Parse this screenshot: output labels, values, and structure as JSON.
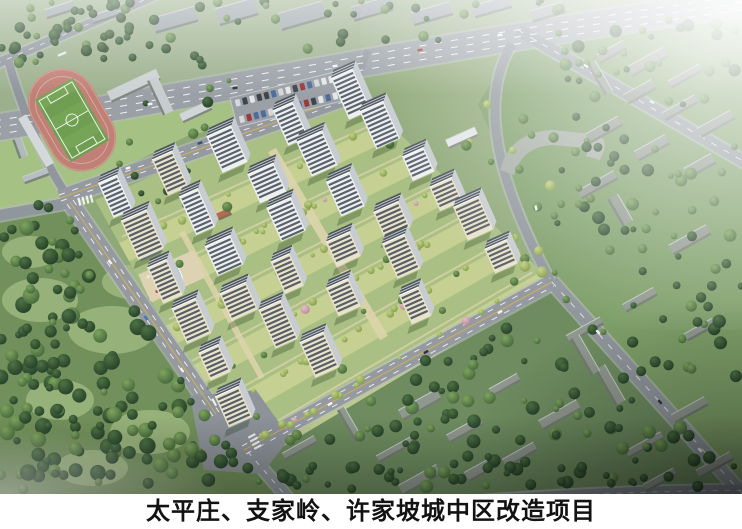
{
  "caption": {
    "text": "太平庄、支家岭、许家坡城中区改造项目"
  },
  "palette": {
    "caption_background": "#ffffff",
    "caption_text": "#121212",
    "haze_white": "#ffffff",
    "grass_base": "#8fa878",
    "forest_dark": "#3c5a34",
    "complex_lawn": "#a9bf83",
    "landscape_band": "#c9d395",
    "path_tan": "#ddd4ac",
    "road_asphalt": "#949aa0",
    "road_sidewalk": "#b8bcc0",
    "lane_marking": "#ffffff",
    "center_line_yellow": "#d9b34c",
    "running_track": "#c08076",
    "soccer_pitch": "#6f9e52",
    "tower_facade_white": "#edeff0",
    "tower_facade_beige": "#e9e2cc",
    "tower_window": "#39434e",
    "tower_roof": "#4e565e",
    "old_building_gray": "#8f988e",
    "city_block_gray": "#9ba4a9",
    "pool_blue": "#3fb3dc"
  }
}
